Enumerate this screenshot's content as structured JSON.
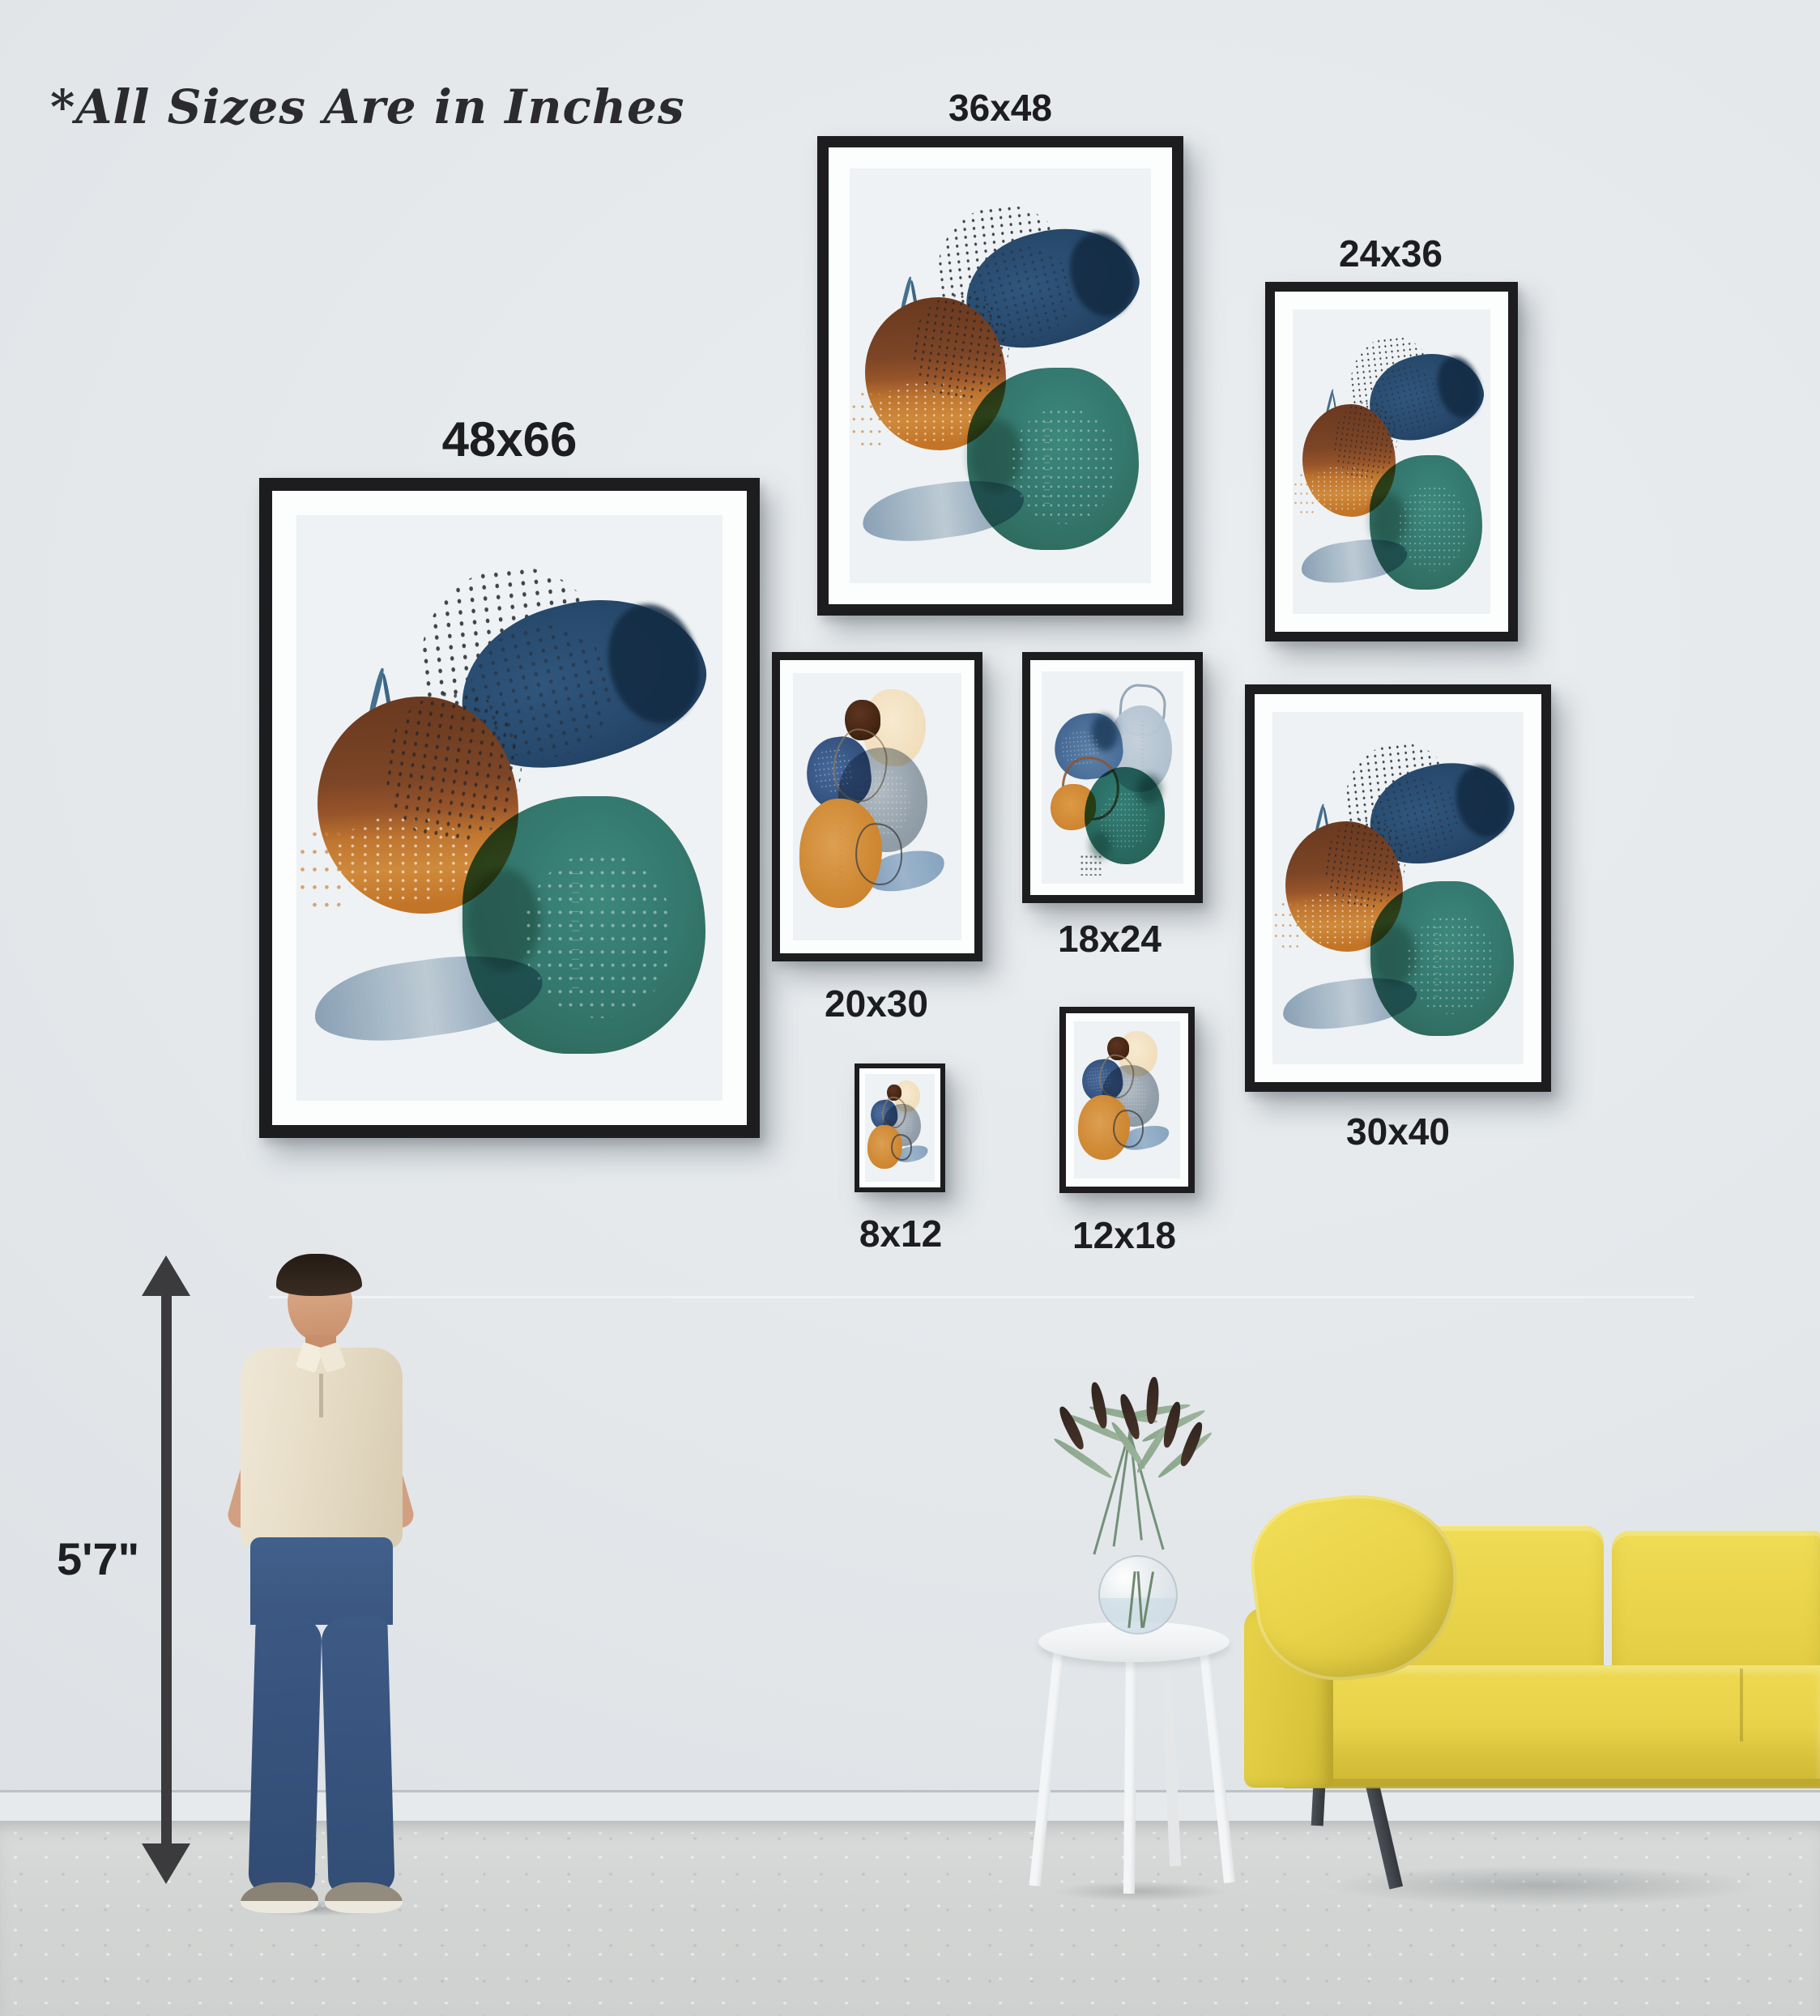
{
  "note": "*All Sizes Are in Inches",
  "frames": [
    {
      "label": "48x66",
      "artwork": "teal-navy-brown-watercolor"
    },
    {
      "label": "36x48",
      "artwork": "teal-navy-brown-watercolor"
    },
    {
      "label": "24x36",
      "artwork": "teal-navy-brown-watercolor"
    },
    {
      "label": "20x30",
      "artwork": "gray-orange-navy-watercolor"
    },
    {
      "label": "18x24",
      "artwork": "slate-teal-orange-watercolor"
    },
    {
      "label": "30x40",
      "artwork": "teal-navy-brown-watercolor"
    },
    {
      "label": "8x12",
      "artwork": "gray-orange-navy-watercolor"
    },
    {
      "label": "12x18",
      "artwork": "gray-orange-navy-watercolor"
    }
  ],
  "person": {
    "height_label": "5'7\""
  },
  "colors": {
    "wall": "#e3e7ea",
    "floor": "#d3d5d4",
    "frame": "#1d1d1f",
    "matte": "#fcfdfd",
    "sofa_yellow": "#e8d24a",
    "teal": "#2f7a6e",
    "navy": "#27496c",
    "brown": "#7c4526",
    "orange": "#cd8738",
    "label_text": "#1d1d1f"
  }
}
